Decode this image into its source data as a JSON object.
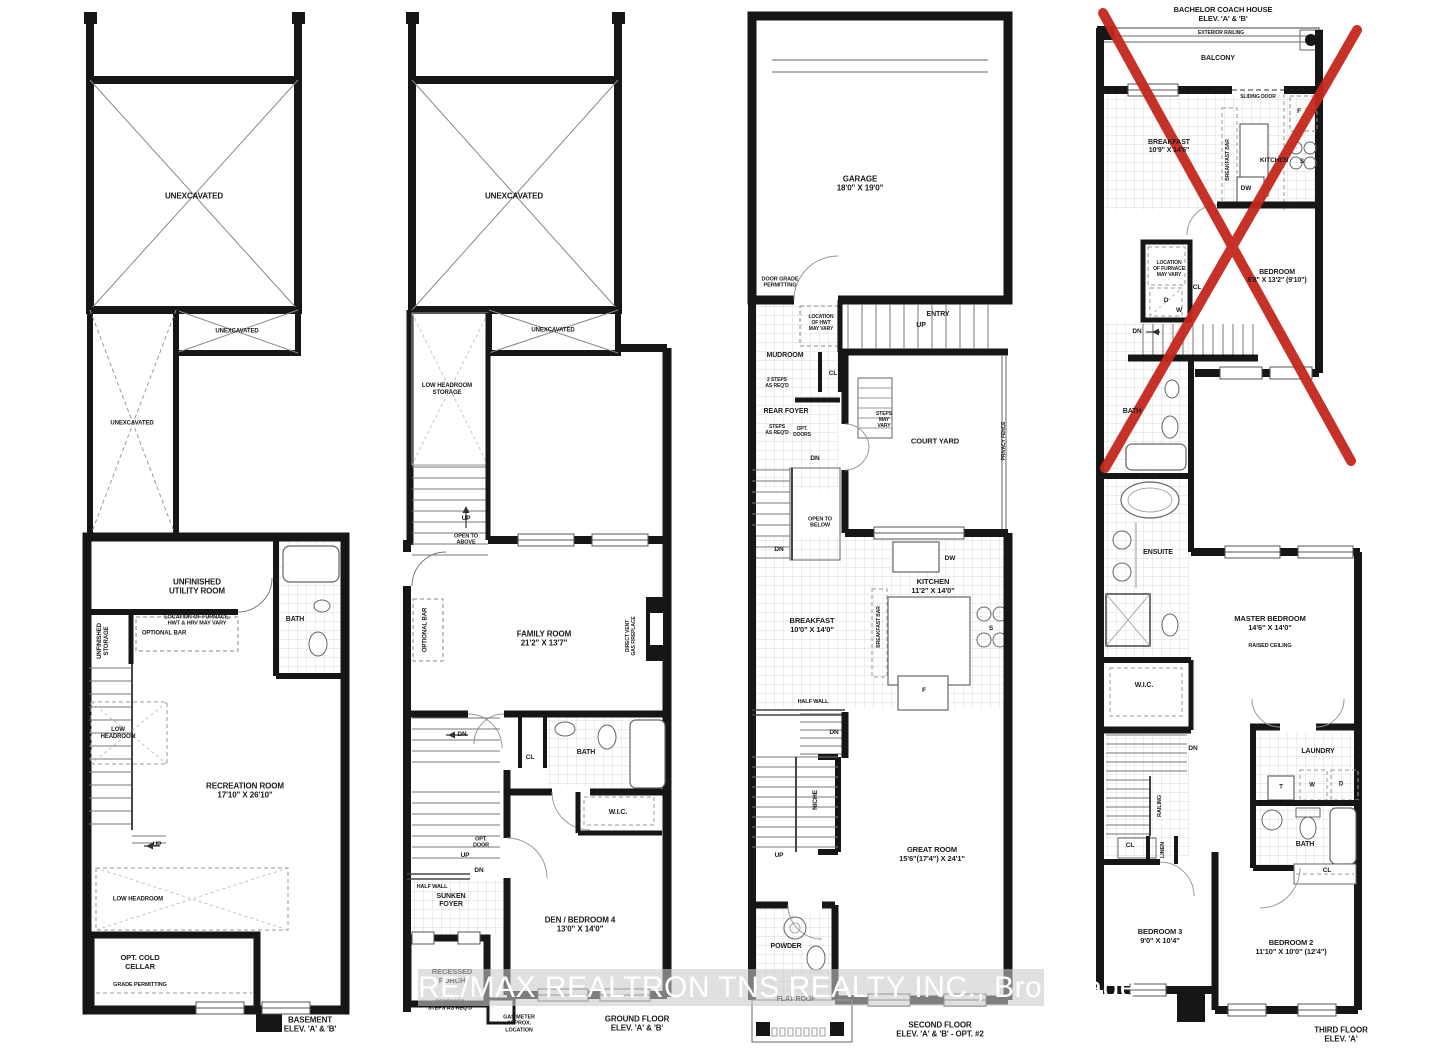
{
  "watermark": "RE/MAX REALTRON TNS REALTY INC., Brokerage",
  "colors": {
    "wall": "#161616",
    "red_x": "#c3271b",
    "watermark_band": "#c9c9c9",
    "watermark_text": "#ffffff"
  },
  "plans": [
    {
      "id": "basement",
      "name": "Basement Plan",
      "labels": [
        {
          "t": "UNEXCAVATED",
          "x": 194,
          "y": 196,
          "s": 8
        },
        {
          "t": "UNEXCAVATED",
          "x": 237,
          "y": 332,
          "s": 6
        },
        {
          "t": "UNEXCAVATED",
          "x": 132,
          "y": 424,
          "s": 6
        },
        {
          "t": "UNFINISHED\nUTILITY ROOM",
          "x": 197,
          "y": 587,
          "s": 8
        },
        {
          "t": "LOCATION OF FURNACE,\nHWT & HRV MAY VARY",
          "x": 197,
          "y": 621,
          "s": 5.5
        },
        {
          "t": "UNFINISHED\nSTORAGE",
          "x": 104,
          "y": 641,
          "s": 6,
          "v": 1
        },
        {
          "t": "OPTIONAL BAR",
          "x": 164,
          "y": 634,
          "s": 6
        },
        {
          "t": "BATH",
          "x": 295,
          "y": 620,
          "s": 7
        },
        {
          "t": "LOW\nHEADROOM",
          "x": 118,
          "y": 734,
          "s": 6
        },
        {
          "t": "RECREATION ROOM\n17'10\" X 26'10\"",
          "x": 245,
          "y": 791,
          "s": 8
        },
        {
          "t": "UP",
          "x": 157,
          "y": 845,
          "s": 6.5
        },
        {
          "t": "LOW HEADROOM",
          "x": 138,
          "y": 900,
          "s": 6
        },
        {
          "t": "OPT. COLD\nCELLAR",
          "x": 140,
          "y": 963,
          "s": 7.5
        },
        {
          "t": "GRADE PERMITTING",
          "x": 140,
          "y": 985,
          "s": 5.5
        },
        {
          "t": "BASEMENT\nELEV. 'A' & 'B'",
          "x": 310,
          "y": 1025,
          "s": 8,
          "n": "floor-title"
        }
      ]
    },
    {
      "id": "ground-floor",
      "name": "Ground Floor Plan",
      "labels": [
        {
          "t": "UNEXCAVATED",
          "x": 514,
          "y": 196,
          "s": 8
        },
        {
          "t": "UNEXCAVATED",
          "x": 553,
          "y": 331,
          "s": 6
        },
        {
          "t": "LOW HEADROOM\nSTORAGE",
          "x": 447,
          "y": 390,
          "s": 6
        },
        {
          "t": "UP",
          "x": 466,
          "y": 519,
          "s": 6.5
        },
        {
          "t": "OPEN TO\nABOVE",
          "x": 466,
          "y": 540,
          "s": 5.5
        },
        {
          "t": "OPTIONAL BAR",
          "x": 426,
          "y": 630,
          "s": 6,
          "v": 1
        },
        {
          "t": "FAMILY ROOM\n21'2\" X 13'7\"",
          "x": 544,
          "y": 639,
          "s": 8
        },
        {
          "t": "DIRECT VENT\nGAS FIREPLACE",
          "x": 632,
          "y": 636,
          "s": 5,
          "v": 1
        },
        {
          "t": "DN",
          "x": 462,
          "y": 735,
          "s": 6.5
        },
        {
          "t": "CL",
          "x": 530,
          "y": 758,
          "s": 6.5
        },
        {
          "t": "BATH",
          "x": 586,
          "y": 753,
          "s": 7
        },
        {
          "t": "W.I.C.",
          "x": 618,
          "y": 813,
          "s": 7
        },
        {
          "t": "OPT.\nDOOR",
          "x": 481,
          "y": 843,
          "s": 5.5
        },
        {
          "t": "UP",
          "x": 465,
          "y": 856,
          "s": 6.5
        },
        {
          "t": "DN",
          "x": 479,
          "y": 871,
          "s": 6.5
        },
        {
          "t": "HALF WALL",
          "x": 432,
          "y": 887,
          "s": 5.5
        },
        {
          "t": "SUNKEN\nFOYER",
          "x": 451,
          "y": 901,
          "s": 7
        },
        {
          "t": "DEN / BEDROOM 4\n13'0\" X 14'0\"",
          "x": 580,
          "y": 925,
          "s": 8
        },
        {
          "t": "RECESSED\nPORCH",
          "x": 452,
          "y": 977,
          "s": 7.5
        },
        {
          "t": "RECESSED\nSTEPS AS REQ'D",
          "x": 450,
          "y": 1006,
          "s": 5.5
        },
        {
          "t": "GAS METER\nAPPROX.\nLOCATION",
          "x": 519,
          "y": 1024,
          "s": 5.5
        },
        {
          "t": "GROUND FLOOR\nELEV. 'A' & 'B'",
          "x": 637,
          "y": 1024,
          "s": 8,
          "n": "floor-title"
        }
      ]
    },
    {
      "id": "second-floor",
      "name": "Second Floor Plan",
      "labels": [
        {
          "t": "GARAGE\n18'0\" X 19'0\"",
          "x": 860,
          "y": 184,
          "s": 8
        },
        {
          "t": "DOOR GRADE\nPERMITTING",
          "x": 780,
          "y": 283,
          "s": 5.5
        },
        {
          "t": "LOCATION\nOF HWT\nMAY VARY",
          "x": 821,
          "y": 324,
          "s": 5
        },
        {
          "t": "ENTRY",
          "x": 938,
          "y": 315,
          "s": 7
        },
        {
          "t": "UP",
          "x": 921,
          "y": 326,
          "s": 7
        },
        {
          "t": "MUDROOM",
          "x": 785,
          "y": 356,
          "s": 7
        },
        {
          "t": "2 STEPS\nAS REQ'D",
          "x": 777,
          "y": 384,
          "s": 5
        },
        {
          "t": "CL",
          "x": 833,
          "y": 374,
          "s": 6.5
        },
        {
          "t": "REAR FOYER",
          "x": 786,
          "y": 412,
          "s": 7
        },
        {
          "t": "STEPS\nAS REQ'D",
          "x": 777,
          "y": 431,
          "s": 5
        },
        {
          "t": "OPT.\nDOORS",
          "x": 802,
          "y": 433,
          "s": 5
        },
        {
          "t": "DN",
          "x": 815,
          "y": 459,
          "s": 6.5
        },
        {
          "t": "STEPS\nMAY\nVARY",
          "x": 884,
          "y": 421,
          "s": 5
        },
        {
          "t": "COURT YARD",
          "x": 935,
          "y": 442,
          "s": 7.5
        },
        {
          "t": "PRIVACY FENCE",
          "x": 1005,
          "y": 441,
          "s": 5,
          "v": 1
        },
        {
          "t": "OPEN TO\nBELOW",
          "x": 820,
          "y": 523,
          "s": 5.5
        },
        {
          "t": "DN",
          "x": 779,
          "y": 550,
          "s": 6.5
        },
        {
          "t": "DW",
          "x": 950,
          "y": 559,
          "s": 6.5
        },
        {
          "t": "KITCHEN\n11'2\" X 14'0\"",
          "x": 933,
          "y": 587,
          "s": 7.5
        },
        {
          "t": "BREAKFAST\n10'0\" X 14'0\"",
          "x": 812,
          "y": 626,
          "s": 7.5
        },
        {
          "t": "BREAKFAST BAR",
          "x": 880,
          "y": 627,
          "s": 5,
          "v": 1
        },
        {
          "t": "S",
          "x": 991,
          "y": 629,
          "s": 6.5
        },
        {
          "t": "F",
          "x": 924,
          "y": 691,
          "s": 6.5
        },
        {
          "t": "HALF WALL",
          "x": 813,
          "y": 702,
          "s": 5.5
        },
        {
          "t": "DN",
          "x": 834,
          "y": 733,
          "s": 6.5
        },
        {
          "t": "NICHE",
          "x": 816,
          "y": 800,
          "s": 6.5,
          "v": 1
        },
        {
          "t": "UP",
          "x": 779,
          "y": 856,
          "s": 6.5
        },
        {
          "t": "GREAT ROOM\n15'6\"(17'4\") X 24'1\"",
          "x": 932,
          "y": 855,
          "s": 7.5
        },
        {
          "t": "POWDER",
          "x": 786,
          "y": 947,
          "s": 7
        },
        {
          "t": "FLAT ROOF",
          "x": 796,
          "y": 1000,
          "s": 7
        },
        {
          "t": "SECOND FLOOR\nELEV. 'A' & 'B' - OPT. #2",
          "x": 940,
          "y": 1030,
          "s": 8,
          "n": "floor-title"
        }
      ]
    },
    {
      "id": "third-floor",
      "name": "Third Floor Plan",
      "labels": [
        {
          "t": "BACHELOR COACH HOUSE\nELEV. 'A' & 'B'",
          "x": 1223,
          "y": 15,
          "s": 7.5,
          "n": "plan-heading"
        },
        {
          "t": "EXTERIOR RAILING",
          "x": 1221,
          "y": 34,
          "s": 5
        },
        {
          "t": "BALCONY",
          "x": 1218,
          "y": 59,
          "s": 7
        },
        {
          "t": "SLIDING DOOR",
          "x": 1258,
          "y": 98,
          "s": 5
        },
        {
          "t": "F",
          "x": 1299,
          "y": 112,
          "s": 6.5
        },
        {
          "t": "BREAKFAST\n10'9\" X 14'6\"",
          "x": 1169,
          "y": 147,
          "s": 7
        },
        {
          "t": "BREAKFAST BAR",
          "x": 1229,
          "y": 160,
          "s": 5,
          "v": 1
        },
        {
          "t": "KITCHEN",
          "x": 1274,
          "y": 161,
          "s": 6.5
        },
        {
          "t": "S",
          "x": 1302,
          "y": 162,
          "s": 6.5
        },
        {
          "t": "DW",
          "x": 1246,
          "y": 189,
          "s": 6.5
        },
        {
          "t": "LOCATION\nOF FURNACE\nMAY VARY",
          "x": 1169,
          "y": 270,
          "s": 5
        },
        {
          "t": "CL",
          "x": 1197,
          "y": 288,
          "s": 6.5
        },
        {
          "t": "D",
          "x": 1166,
          "y": 301,
          "s": 6.5
        },
        {
          "t": "W",
          "x": 1179,
          "y": 311,
          "s": 6.5
        },
        {
          "t": "BEDROOM\n8'8\" X 13'2\" (9'10\")",
          "x": 1277,
          "y": 277,
          "s": 7
        },
        {
          "t": "DN",
          "x": 1137,
          "y": 332,
          "s": 6.5
        },
        {
          "t": "BATH",
          "x": 1132,
          "y": 412,
          "s": 7
        },
        {
          "t": "ENSUITE",
          "x": 1158,
          "y": 553,
          "s": 7
        },
        {
          "t": "MASTER BEDROOM\n14'6\" X 14'0\"",
          "x": 1270,
          "y": 624,
          "s": 7.5
        },
        {
          "t": "RAISED CEILING",
          "x": 1270,
          "y": 646,
          "s": 5.5
        },
        {
          "t": "W.I.C.",
          "x": 1144,
          "y": 686,
          "s": 7
        },
        {
          "t": "DN",
          "x": 1193,
          "y": 749,
          "s": 6.5
        },
        {
          "t": "LAUNDRY",
          "x": 1318,
          "y": 752,
          "s": 7
        },
        {
          "t": "T",
          "x": 1281,
          "y": 788,
          "s": 6
        },
        {
          "t": "W",
          "x": 1312,
          "y": 786,
          "s": 6
        },
        {
          "t": "D",
          "x": 1341,
          "y": 785,
          "s": 6
        },
        {
          "t": "RAILING",
          "x": 1160,
          "y": 806,
          "s": 5.5,
          "v": 1
        },
        {
          "t": "CL",
          "x": 1130,
          "y": 846,
          "s": 6.5
        },
        {
          "t": "LINEN",
          "x": 1163,
          "y": 850,
          "s": 5.5,
          "v": 1
        },
        {
          "t": "BATH",
          "x": 1305,
          "y": 845,
          "s": 7
        },
        {
          "t": "CL",
          "x": 1327,
          "y": 871,
          "s": 6.5
        },
        {
          "t": "BEDROOM 3\n9'0\" X 10'4\"",
          "x": 1160,
          "y": 937,
          "s": 7.5
        },
        {
          "t": "BEDROOM 2\n11'10\" X 10'0\" (12'4\")",
          "x": 1291,
          "y": 948,
          "s": 7.5
        },
        {
          "t": "THIRD FLOOR\nELEV. 'A'",
          "x": 1341,
          "y": 1035,
          "s": 8,
          "n": "floor-title"
        }
      ]
    }
  ]
}
